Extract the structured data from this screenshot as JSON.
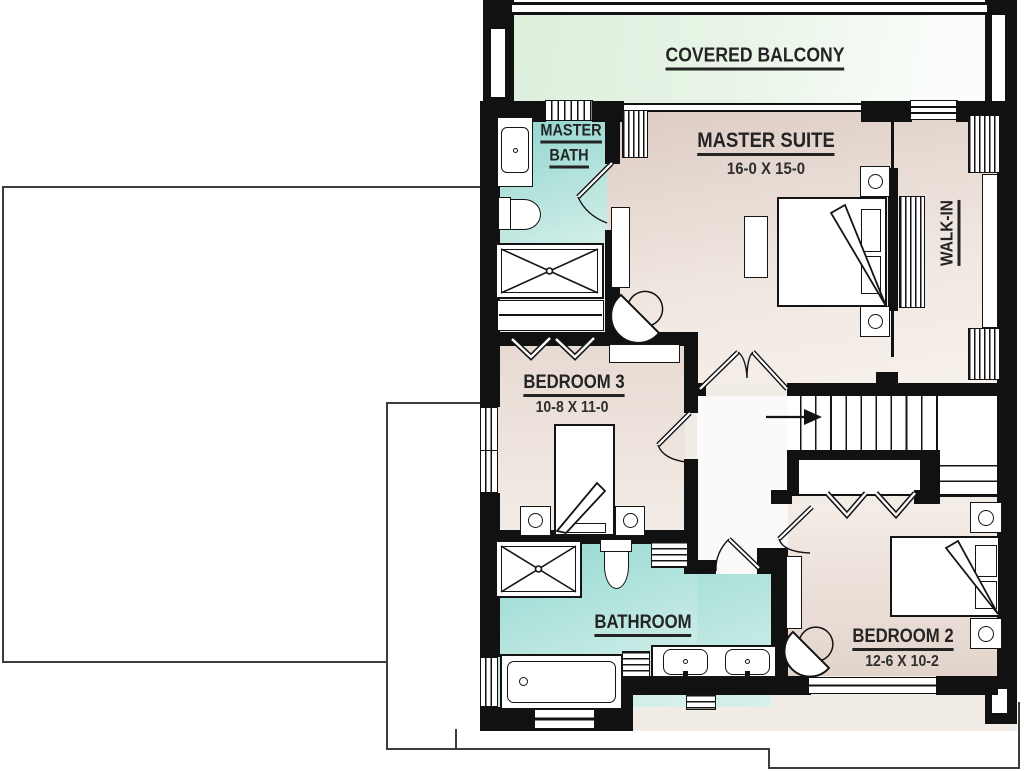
{
  "plan": {
    "title": "Second floor plan",
    "rooms": {
      "covered_balcony": {
        "name": "COVERED BALCONY"
      },
      "master_suite": {
        "name": "MASTER SUITE",
        "dims": "16-0 X 15-0"
      },
      "master_bath": {
        "line1": "MASTER",
        "line2": "BATH"
      },
      "walk_in": {
        "name": "WALK-IN"
      },
      "bedroom3": {
        "name": "BEDROOM 3",
        "dims": "10-8 X 11-0"
      },
      "bathroom": {
        "name": "BATHROOM"
      },
      "bedroom2": {
        "name": "BEDROOM 2",
        "dims": "12-6 X 10-2"
      }
    },
    "colors": {
      "wall": "#111111",
      "balcony_floor": "#e2f1e0",
      "bath_floor": "#8ed5cd",
      "bedroom_floor": "#e3d5cc",
      "text": "#242424"
    },
    "icons": {
      "stair_direction": "down-arrow-icon"
    }
  }
}
